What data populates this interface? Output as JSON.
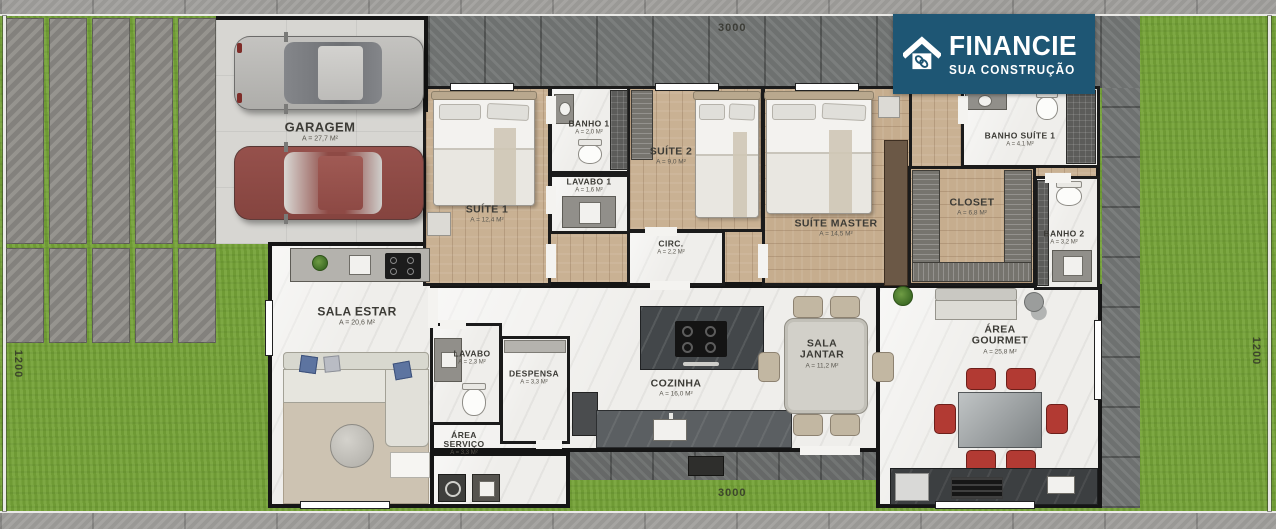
{
  "logo": {
    "title": "FINANCIE",
    "subtitle": "SUA CONSTRUÇÃO",
    "icon": "house-chain-icon",
    "background": "#1e5674"
  },
  "dimensions": {
    "top": "3000",
    "bottom": "3000",
    "left": "1200",
    "right": "1200"
  },
  "rooms": {
    "garagem": {
      "name": "GARAGEM",
      "area": "A = 27,7 M²"
    },
    "suite1": {
      "name": "SUÍTE 1",
      "area": "A = 12,4 M²"
    },
    "banho1": {
      "name": "BANHO 1",
      "area": "A = 2,0 M²"
    },
    "lavabo1": {
      "name": "LAVABO 1",
      "area": "A = 1,6 M²"
    },
    "suite2": {
      "name": "SUÍTE 2",
      "area": "A = 9,0 M²"
    },
    "circ": {
      "name": "CIRC.",
      "area": "A = 2,2 M²"
    },
    "suiteMaster": {
      "name": "SUÍTE MASTER",
      "area": "A = 14,5 M²"
    },
    "closet": {
      "name": "CLOSET",
      "area": "A = 6,8 M²"
    },
    "banhoSuite1": {
      "name": "BANHO SUÍTE 1",
      "area": "A = 4,1 M²"
    },
    "banho2": {
      "name": "BANHO 2",
      "area": "A = 3,2 M²"
    },
    "salaEstar": {
      "name": "SALA ESTAR",
      "area": "A = 20,6 M²"
    },
    "lavabo": {
      "name": "LAVABO",
      "area": "A = 2,3 M²"
    },
    "despensa": {
      "name": "DESPENSA",
      "area": "A = 3,3 M²"
    },
    "areaServico": {
      "name": "ÁREA SERVIÇO",
      "area": "A = 3,3 M²"
    },
    "cozinha": {
      "name": "COZINHA",
      "area": "A = 16,0 M²"
    },
    "salaJantar": {
      "name": "SALA JANTAR",
      "area": "A = 11,2 M²"
    },
    "areaGourmet": {
      "name": "ÁREA GOURMET",
      "area": "A = 25,8 M²"
    }
  },
  "colors": {
    "logo_bg": "#1e5674",
    "grass": "#76a339",
    "wood_floor": "#c9b193",
    "marble_floor": "#efeeeb",
    "chair_red": "#b23a33"
  }
}
